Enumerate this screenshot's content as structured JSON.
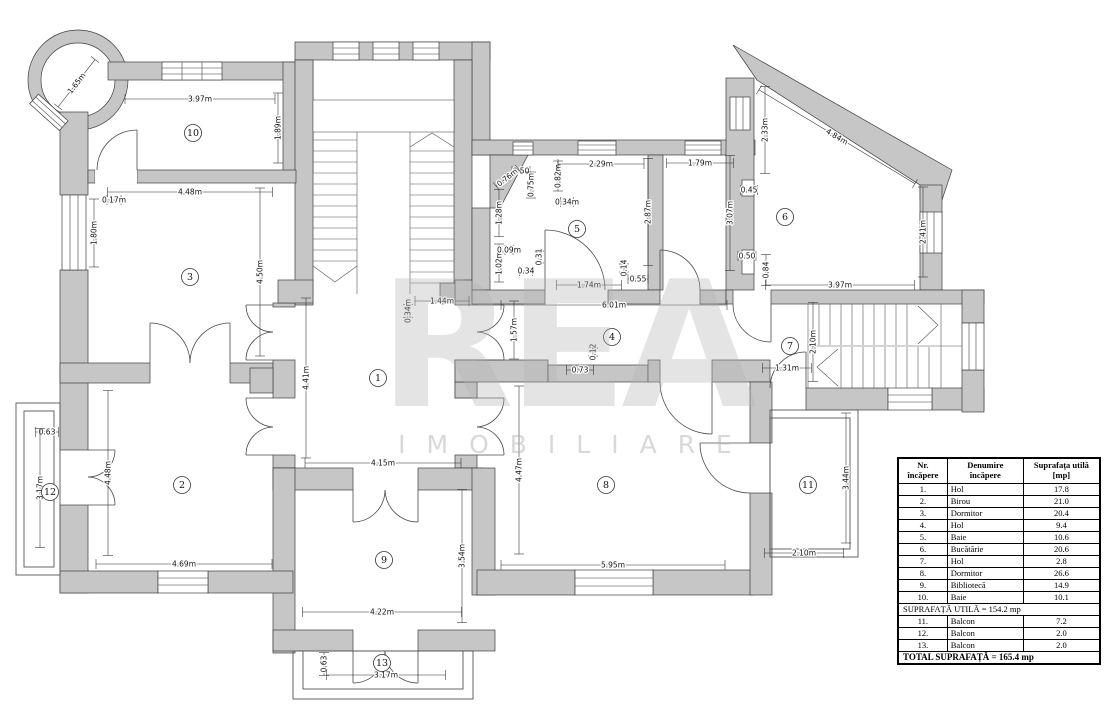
{
  "colors": {
    "wall_fill": "#c6c6c6",
    "line": "#3f3f3f"
  },
  "watermark": {
    "line1": "REA",
    "line2": "IMOBILIARE"
  },
  "rooms": [
    {
      "num": "1",
      "x": 378,
      "y": 378
    },
    {
      "num": "2",
      "x": 182,
      "y": 485
    },
    {
      "num": "3",
      "x": 190,
      "y": 277
    },
    {
      "num": "4",
      "x": 612,
      "y": 337
    },
    {
      "num": "5",
      "x": 577,
      "y": 229
    },
    {
      "num": "6",
      "x": 785,
      "y": 217
    },
    {
      "num": "7",
      "x": 790,
      "y": 346
    },
    {
      "num": "8",
      "x": 606,
      "y": 485
    },
    {
      "num": "9",
      "x": 384,
      "y": 560
    },
    {
      "num": "10",
      "x": 193,
      "y": 133
    },
    {
      "num": "11",
      "x": 808,
      "y": 485
    },
    {
      "num": "12",
      "x": 50,
      "y": 492
    },
    {
      "num": "13",
      "x": 382,
      "y": 663
    }
  ],
  "dimensions": [
    {
      "t": "1.65m",
      "x": 75,
      "y": 82,
      "r": -52,
      "len": 60
    },
    {
      "t": "3.97m",
      "x": 200,
      "y": 97,
      "r": 0,
      "len": 150
    },
    {
      "t": "1.89m",
      "x": 276,
      "y": 128,
      "r": -90,
      "len": 70
    },
    {
      "t": "4.48m",
      "x": 190,
      "y": 190,
      "r": 0,
      "len": 165
    },
    {
      "t": "0.17m",
      "x": 114,
      "y": 198,
      "r": 0,
      "len": 14
    },
    {
      "t": "1.80m",
      "x": 92,
      "y": 233,
      "r": -90,
      "len": 68
    },
    {
      "t": "4.50m",
      "x": 258,
      "y": 272,
      "r": -90,
      "len": 168
    },
    {
      "t": "0.50",
      "x": 521,
      "y": 169,
      "r": 0,
      "len": 18
    },
    {
      "t": "0.76m",
      "x": 506,
      "y": 176,
      "r": -38,
      "len": 28
    },
    {
      "t": "0.75m",
      "x": 529,
      "y": 185,
      "r": -90,
      "len": 26
    },
    {
      "t": "0.82m",
      "x": 556,
      "y": 176,
      "r": -90,
      "len": 30
    },
    {
      "t": "0.34m",
      "x": 567,
      "y": 200,
      "r": 0,
      "len": 13
    },
    {
      "t": "1.28m",
      "x": 497,
      "y": 213,
      "r": -90,
      "len": 47
    },
    {
      "t": "1.02m",
      "x": 497,
      "y": 263,
      "r": -90,
      "len": 38
    },
    {
      "t": "0.09m",
      "x": 509,
      "y": 248,
      "r": 0,
      "len": 8
    },
    {
      "t": "2.29m",
      "x": 601,
      "y": 162,
      "r": 0,
      "len": 86
    },
    {
      "t": "2.87m",
      "x": 646,
      "y": 212,
      "r": -90,
      "len": 107
    },
    {
      "t": "0.31",
      "x": 537,
      "y": 257,
      "r": -90,
      "len": 12
    },
    {
      "t": "0.34",
      "x": 526,
      "y": 269,
      "r": 0,
      "len": 13
    },
    {
      "t": "0.14",
      "x": 622,
      "y": 268,
      "r": -90,
      "len": 8
    },
    {
      "t": "0.55",
      "x": 638,
      "y": 277,
      "r": 0,
      "len": 20
    },
    {
      "t": "1.74m",
      "x": 589,
      "y": 283,
      "r": 0,
      "len": 65
    },
    {
      "t": "1.79m",
      "x": 700,
      "y": 161,
      "r": 0,
      "len": 67
    },
    {
      "t": "3.07m",
      "x": 728,
      "y": 213,
      "r": -90,
      "len": 115
    },
    {
      "t": "0.45",
      "x": 749,
      "y": 188,
      "r": 0,
      "len": 17
    },
    {
      "t": "0.50",
      "x": 747,
      "y": 254,
      "r": 0,
      "len": 18
    },
    {
      "t": "0.84",
      "x": 764,
      "y": 270,
      "r": -90,
      "len": 31
    },
    {
      "t": "2.33m",
      "x": 763,
      "y": 130,
      "r": -90,
      "len": 87
    },
    {
      "t": "4.84m",
      "x": 838,
      "y": 135,
      "r": 31,
      "len": 182
    },
    {
      "t": "2.41m",
      "x": 921,
      "y": 232,
      "r": -90,
      "len": 90
    },
    {
      "t": "3.97m",
      "x": 840,
      "y": 283,
      "r": 0,
      "len": 149
    },
    {
      "t": "6.01m",
      "x": 614,
      "y": 303,
      "r": 0,
      "len": 226
    },
    {
      "t": "1.57m",
      "x": 512,
      "y": 330,
      "r": -90,
      "len": 58
    },
    {
      "t": "1.44m",
      "x": 442,
      "y": 299,
      "r": 0,
      "len": 54
    },
    {
      "t": "0.34m",
      "x": 406,
      "y": 311,
      "r": -90,
      "len": 13
    },
    {
      "t": "0.12",
      "x": 591,
      "y": 352,
      "r": -90,
      "len": 8
    },
    {
      "t": "0.73",
      "x": 580,
      "y": 368,
      "r": 0,
      "len": 27
    },
    {
      "t": "2.10m",
      "x": 811,
      "y": 342,
      "r": -90,
      "len": 79
    },
    {
      "t": "1.31m",
      "x": 787,
      "y": 366,
      "r": 0,
      "len": 49
    },
    {
      "t": "4.41m",
      "x": 304,
      "y": 378,
      "r": -90,
      "len": 160
    },
    {
      "t": "4.15m",
      "x": 383,
      "y": 461,
      "r": 0,
      "len": 156
    },
    {
      "t": "0.63",
      "x": 47,
      "y": 430,
      "r": 0,
      "len": 23
    },
    {
      "t": "3.17m",
      "x": 38,
      "y": 488,
      "r": -90,
      "len": 119
    },
    {
      "t": "4.48m",
      "x": 106,
      "y": 473,
      "r": -90,
      "len": 165
    },
    {
      "t": "4.69m",
      "x": 184,
      "y": 562,
      "r": 0,
      "len": 176
    },
    {
      "t": "4.47m",
      "x": 517,
      "y": 470,
      "r": -90,
      "len": 168
    },
    {
      "t": "3.54m",
      "x": 460,
      "y": 556,
      "r": -90,
      "len": 133
    },
    {
      "t": "4.22m",
      "x": 382,
      "y": 610,
      "r": 0,
      "len": 159
    },
    {
      "t": "0.63",
      "x": 322,
      "y": 664,
      "r": -90,
      "len": 23
    },
    {
      "t": "3.17m",
      "x": 386,
      "y": 673,
      "r": 0,
      "len": 119
    },
    {
      "t": "5.95m",
      "x": 613,
      "y": 563,
      "r": 0,
      "len": 224
    },
    {
      "t": "3.44m",
      "x": 844,
      "y": 478,
      "r": -90,
      "len": 130
    },
    {
      "t": "2.10m",
      "x": 804,
      "y": 551,
      "r": 0,
      "len": 79
    }
  ],
  "table": {
    "header": {
      "col1_line1": "Nr.",
      "col1_line2": "încăpere",
      "col2_line1": "Denumire",
      "col2_line2": "încăpere",
      "col3_line1": "Suprafața utilă",
      "col3_line2": "[mp]"
    },
    "rows": [
      {
        "nr": "1.",
        "name": "Hol",
        "area": "17.8"
      },
      {
        "nr": "2.",
        "name": "Birou",
        "area": "21.0"
      },
      {
        "nr": "3.",
        "name": "Dormitor",
        "area": "20.4"
      },
      {
        "nr": "4.",
        "name": "Hol",
        "area": "9.4"
      },
      {
        "nr": "5.",
        "name": "Baie",
        "area": "10.6"
      },
      {
        "nr": "6.",
        "name": "Bucătărie",
        "area": "20.6"
      },
      {
        "nr": "7.",
        "name": "Hol",
        "area": "2.8"
      },
      {
        "nr": "8.",
        "name": "Dormitor",
        "area": "26.6"
      },
      {
        "nr": "9.",
        "name": "Bibliotecă",
        "area": "14.9"
      },
      {
        "nr": "10.",
        "name": "Baie",
        "area": "10.1"
      }
    ],
    "subtotal": "SUPRAFAȚĂ UTILĂ = 154.2 mp",
    "balcony_rows": [
      {
        "nr": "11.",
        "name": "Balcon",
        "area": "7.2"
      },
      {
        "nr": "12.",
        "name": "Balcon",
        "area": "2.0"
      },
      {
        "nr": "13.",
        "name": "Balcon",
        "area": "2.0"
      }
    ],
    "total": "TOTAL SUPRAFAȚĂ = 165.4 mp"
  }
}
